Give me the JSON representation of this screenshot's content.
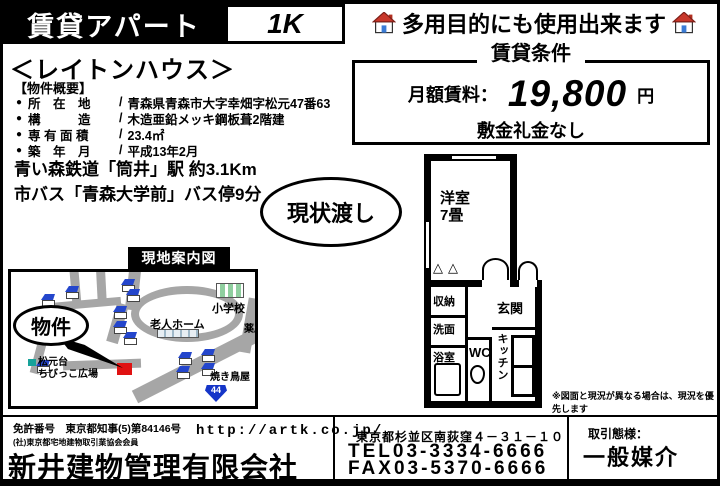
{
  "colors": {
    "road_gray": "#a6a6a6",
    "house_roof_blue": "#2446cc",
    "marker_red": "#e01212",
    "pharmacy_green": "#12a02c",
    "route_badge_blue": "#1535c8"
  },
  "header": {
    "title": "賃貸アパート",
    "layout_type": "1K",
    "tagline": "多用目的にも使用出来ます"
  },
  "terms": {
    "title": "賃貸条件",
    "rent_label": "月額賃料：",
    "rent_amount": "19,800",
    "rent_unit": "円",
    "deposit_note": "敷金礼金なし"
  },
  "property": {
    "name": "＜レイトンハウス＞",
    "overview_label": "【物件概要】",
    "bullet": "●",
    "separator": "/",
    "details": [
      {
        "label": "所　在　地",
        "value": "青森県青森市大字幸畑字松元47番63"
      },
      {
        "label": "構　　　造",
        "value": "木造亜鉛メッキ鋼板葺2階建"
      },
      {
        "label": "専 有 面 積",
        "value": "23.4㎡"
      },
      {
        "label": "築　年　月",
        "value": "平成13年2月"
      }
    ],
    "access_line1": "青い森鉄道「筒井」駅 約3.1Km",
    "access_line2": "市バス「青森大学前」バス停9分",
    "condition_badge": "現状渡し"
  },
  "floorplan": {
    "main_room_line1": "洋室",
    "main_room_line2": "7畳",
    "closet": "収納",
    "washroom": "洗面",
    "bath": "浴室",
    "wc": "WC",
    "kitchen": "キッチン",
    "entrance": "玄関",
    "door_marks": "△△",
    "disclaimer": "※図面と現況が異なる場合は、現況を優先します"
  },
  "map": {
    "title": "現地案内図",
    "property_label": "物件",
    "school": "小学校",
    "pharmacy": "薬局",
    "nursing_home": "老人ホーム",
    "playground_line1": "松元台",
    "playground_line2": "ちびっこ広場",
    "yakitori": "焼き鳥屋",
    "route_number": "44"
  },
  "footer": {
    "license": "免許番号　東京都知事(5)第84146号",
    "membership": "(社)東京都宅地建物取引業協会会員",
    "url": "http://artk.co.jp/",
    "company": "新井建物管理有限会社",
    "address": "東京都杉並区南荻窪４－３１－１０",
    "tel": "TEL03-3334-6666",
    "fax": "FAX03-5370-6666",
    "transaction_label": "取引態様：",
    "transaction_type": "一般媒介"
  }
}
